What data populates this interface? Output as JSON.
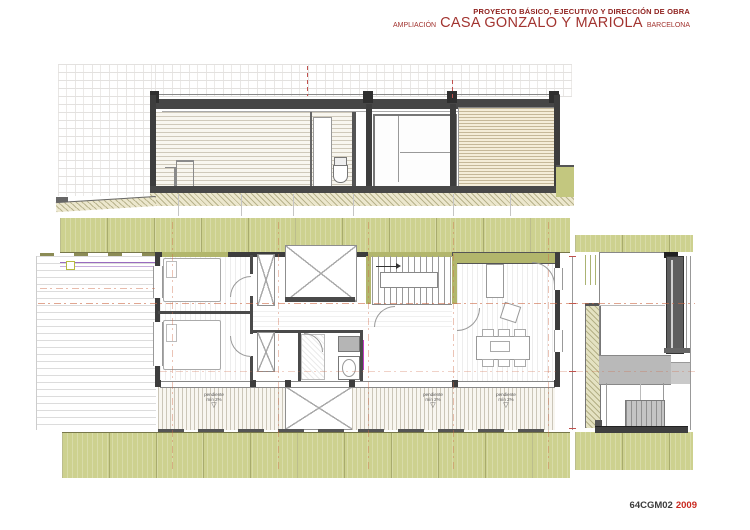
{
  "document": {
    "header": {
      "line1": "PROYECTO BÁSICO, EJECUTIVO Y DIRECCIÓN DE OBRA",
      "project_prefix": "AMPLIACIÓN",
      "project_name": "CASA GONZALO Y MARIOLA",
      "project_location": "BARCELONA"
    },
    "footer": {
      "sheet_code": "64CGM02",
      "sheet_year": "2009"
    }
  },
  "plan": {
    "slope_labels": [
      {
        "line1": "pendiente",
        "line2": "mín 2%"
      },
      {
        "line1": "pendiente",
        "line2": "mín 2%"
      },
      {
        "line1": "pendiente",
        "line2": "mín 2%"
      }
    ]
  },
  "icons": {
    "slope_triangle": "▽"
  },
  "colors": {
    "title-red": "#8e1f1c",
    "subtitle-red": "#a23430",
    "year-red": "#c9281e",
    "code-gray": "#3c3c3c",
    "olive": "#cdd18f",
    "olive-wall": "#b2b66c",
    "wall-dark": "#3d3d3d",
    "axis-orange": "#cd6a48",
    "deck-purple": "#9a6bc0",
    "marker-yellow": "#b7ba42",
    "magenta": "#c23ac2"
  }
}
